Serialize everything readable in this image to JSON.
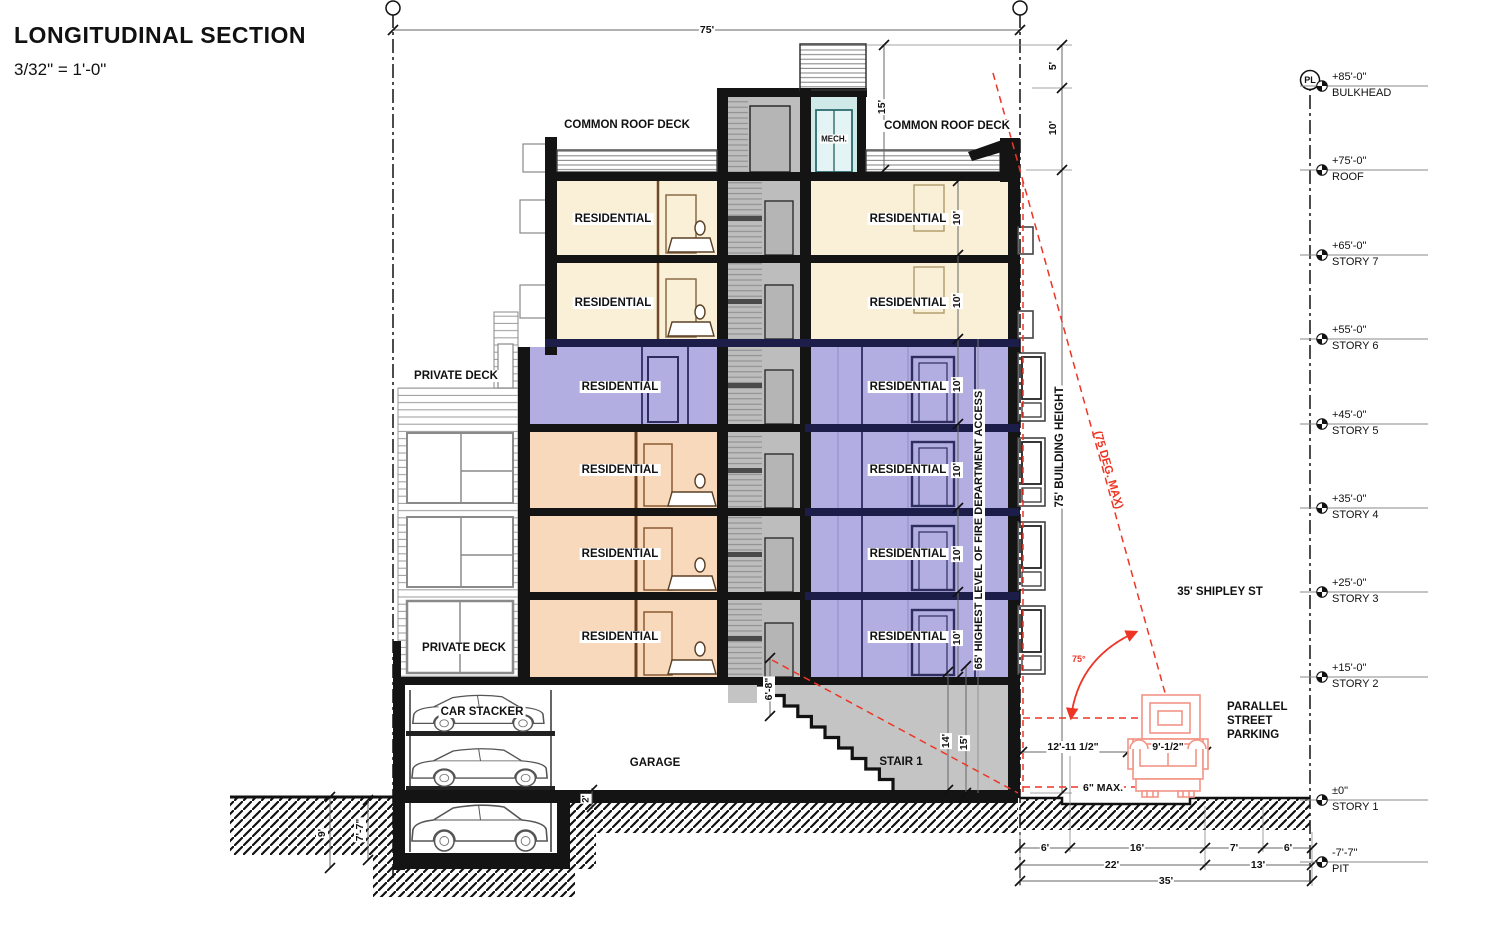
{
  "title": {
    "heading": "LONGITUDINAL SECTION",
    "scale": "3/32\" = 1'-0\""
  },
  "rooms": {
    "residential": "RESIDENTIAL",
    "common_roof_deck": "COMMON ROOF DECK",
    "private_deck": "PRIVATE DECK",
    "mech": "MECH.",
    "car_stacker": "CAR STACKER",
    "garage": "GARAGE",
    "stair1": "STAIR 1"
  },
  "street": {
    "name": "35' SHIPLEY ST",
    "parking": "PARALLEL\nSTREET\nPARKING",
    "curb": "6\" MAX.",
    "truck_offset": "12'-11 1/2\"",
    "truck_width": "9'-1/2\""
  },
  "height_notes": {
    "building_height": "75' BUILDING HEIGHT",
    "fire_access": "65' HIGHEST LEVEL OF FIRE DEPARTMENT ACCESS",
    "angle_note": "(75 DEG. MAX)",
    "angle": "75°",
    "pl": "PL"
  },
  "dims": {
    "overall_width": "75'",
    "bulkhead_height": "15'",
    "parapet_5": "5'",
    "bulkhead_10": "10'",
    "floor_height": "10'",
    "stair_head": "6'-8\"",
    "stair_14": "14'",
    "stair_15": "15'",
    "slab_step": "2'",
    "pit_depth_9": "9'",
    "pit_7_7": "7'-7\"",
    "w6a": "6'",
    "w16": "16'",
    "w7": "7'",
    "w6b": "6'",
    "w22": "22'",
    "w13": "13'",
    "w35": "35'"
  },
  "levels": [
    {
      "elev": "+85'-0\"",
      "name": "BULKHEAD"
    },
    {
      "elev": "+75'-0\"",
      "name": "ROOF"
    },
    {
      "elev": "+65'-0\"",
      "name": "STORY 7"
    },
    {
      "elev": "+55'-0\"",
      "name": "STORY 6"
    },
    {
      "elev": "+45'-0\"",
      "name": "STORY 5"
    },
    {
      "elev": "+35'-0\"",
      "name": "STORY 4"
    },
    {
      "elev": "+25'-0\"",
      "name": "STORY 3"
    },
    {
      "elev": "+15'-0\"",
      "name": "STORY 2"
    },
    {
      "elev": "±0\"",
      "name": "STORY 1"
    },
    {
      "elev": "-7'-7\"",
      "name": "PIT"
    }
  ],
  "colors": {
    "residential_cream": "#FAF0D8",
    "residential_purple": "#B3AEE2",
    "residential_orange": "#F8D9BC",
    "mech_teal": "#CFE9E9",
    "stair_gray": "#BDBDBD",
    "annotation_red": "#EE3525",
    "truck_salmon": "#F29486",
    "slab_navy": "#1D1D49"
  }
}
